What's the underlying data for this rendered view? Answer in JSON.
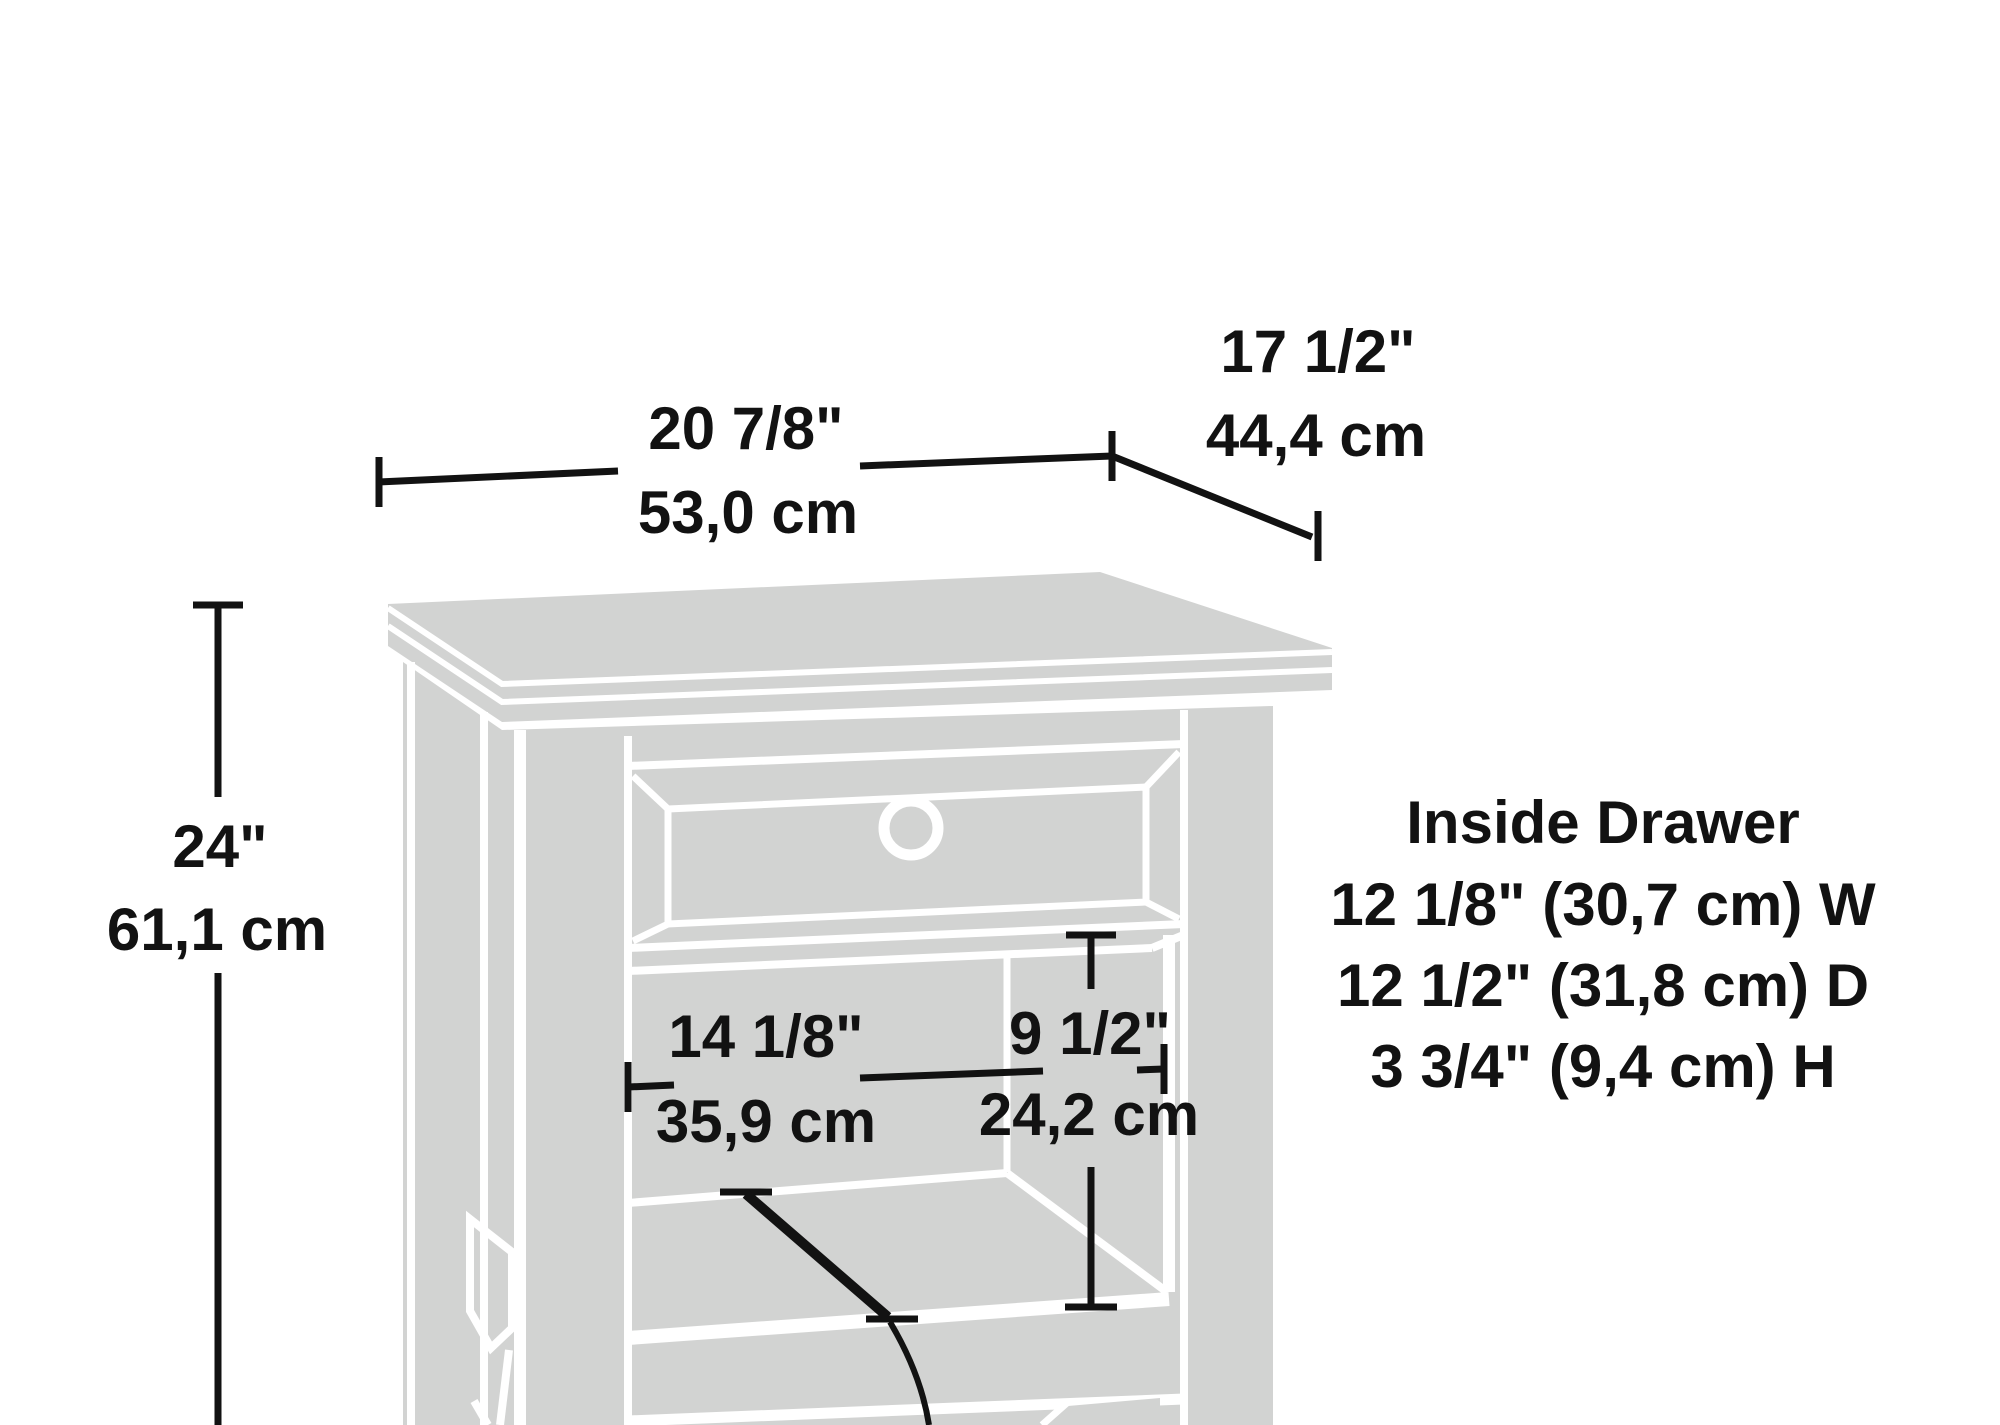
{
  "overall": {
    "width_in": "20 7/8\"",
    "width_cm": "53,0 cm",
    "depth_in": "17 1/2\"",
    "depth_cm": "44,4 cm",
    "height_in": "24\"",
    "height_cm": "61,1 cm"
  },
  "opening": {
    "width_in": "14 1/8\"",
    "width_cm": "35,9 cm",
    "height_in": "9 1/2\"",
    "height_cm": "24,2 cm"
  },
  "inside_drawer": {
    "heading": "Inside Drawer",
    "width_line": "12 1/8\" (30,7 cm) W",
    "depth_line": "12 1/2\" (31,8 cm) D",
    "height_line": "3 3/4\" (9,4 cm) H"
  },
  "colors": {
    "furniture_fill": "#d2d3d2",
    "line_black": "#121212",
    "background": "#ffffff",
    "panel_gap_white": "#ffffff"
  }
}
